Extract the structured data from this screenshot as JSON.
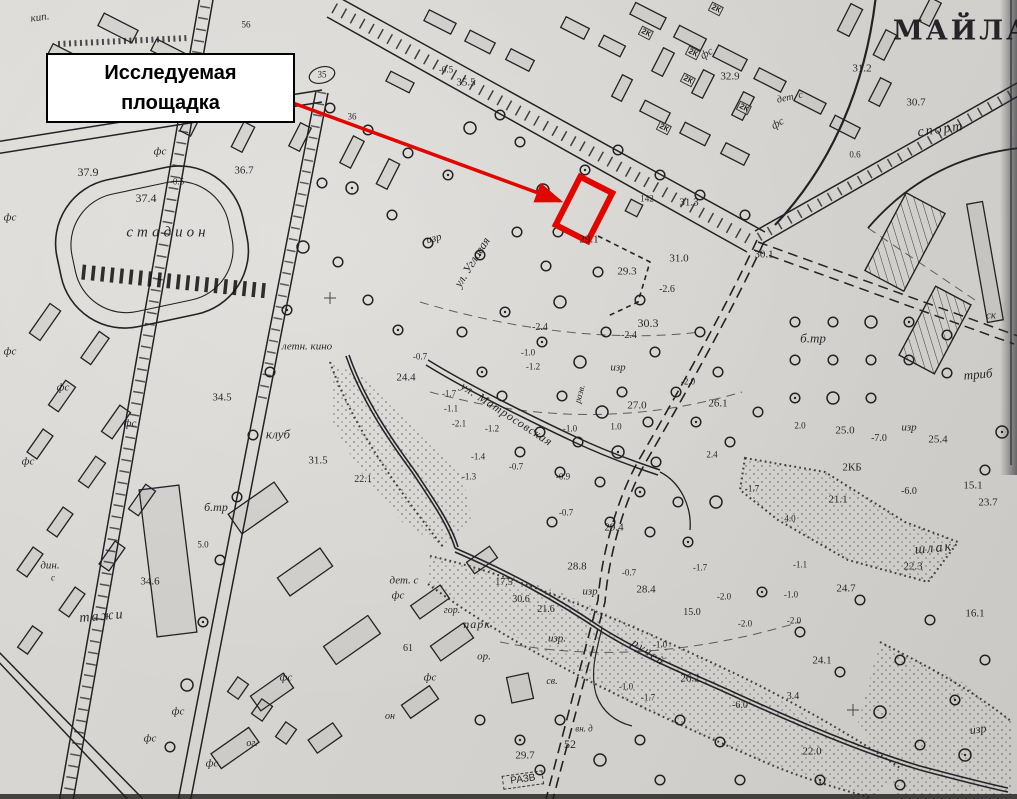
{
  "annotation": {
    "line1": "Исследуемая",
    "line2": "площадка"
  },
  "colors": {
    "paper": "#d6d4d0",
    "ink": "#222222",
    "highlight_red": "#e10600"
  },
  "map": {
    "title_street": "МАЙЛА",
    "street_names": [
      "ул. Угловая",
      "ул. Матросовская"
    ],
    "place_names": [
      "стадион",
      "спорт",
      "клуб",
      "летн. кино",
      "ручей",
      "шлак",
      "парк"
    ],
    "labels": [
      {
        "t": "МАЙЛА",
        "x": 962,
        "y": 31,
        "c": "b",
        "s": 27,
        "ls": 3
      },
      {
        "t": "стадион",
        "x": 168,
        "y": 233,
        "c": "p",
        "s": 15,
        "ls": 4
      },
      {
        "t": "спорт",
        "x": 941,
        "y": 130,
        "c": "p",
        "s": 14,
        "ls": 2,
        "r": -8
      },
      {
        "t": "ул. Угловая",
        "x": 472,
        "y": 262,
        "c": "p",
        "s": 12,
        "r": -58
      },
      {
        "t": "ул. Матросовская",
        "x": 507,
        "y": 414,
        "c": "p",
        "s": 12,
        "ls": 1,
        "r": 33
      },
      {
        "t": "клуб",
        "x": 278,
        "y": 434,
        "c": "p",
        "s": 13
      },
      {
        "t": "летн. кино",
        "x": 307,
        "y": 347,
        "c": "p",
        "s": 11
      },
      {
        "t": "ручей",
        "x": 649,
        "y": 652,
        "c": "p",
        "s": 12,
        "ls": 2,
        "r": 35
      },
      {
        "t": "шлак",
        "x": 934,
        "y": 549,
        "c": "p",
        "s": 14,
        "ls": 2,
        "r": -5
      },
      {
        "t": "б.тр",
        "x": 813,
        "y": 338,
        "c": "p",
        "s": 13
      },
      {
        "t": "б.тр",
        "x": 216,
        "y": 507,
        "c": "p",
        "s": 12
      },
      {
        "t": "изр",
        "x": 434,
        "y": 239,
        "c": "p",
        "s": 11,
        "r": -15
      },
      {
        "t": "изр",
        "x": 618,
        "y": 368,
        "c": "p",
        "s": 11
      },
      {
        "t": "изр",
        "x": 909,
        "y": 428,
        "c": "p",
        "s": 11
      },
      {
        "t": "изр",
        "x": 590,
        "y": 592,
        "c": "p",
        "s": 11
      },
      {
        "t": "изр.",
        "x": 557,
        "y": 639,
        "c": "p",
        "s": 11
      },
      {
        "t": "изр",
        "x": 978,
        "y": 729,
        "c": "p",
        "s": 12,
        "r": -8
      },
      {
        "t": "дет. с",
        "x": 790,
        "y": 98,
        "c": "p",
        "s": 10,
        "r": -12
      },
      {
        "t": "дет. с",
        "x": 404,
        "y": 581,
        "c": "p",
        "s": 11
      },
      {
        "t": "фс",
        "x": 398,
        "y": 596,
        "c": "p",
        "s": 11
      },
      {
        "t": "фс",
        "x": 707,
        "y": 54,
        "c": "p",
        "s": 11,
        "r": -30
      },
      {
        "t": "фс",
        "x": 778,
        "y": 124,
        "c": "p",
        "s": 11,
        "r": -30
      },
      {
        "t": "фс",
        "x": 160,
        "y": 152,
        "c": "p",
        "s": 11
      },
      {
        "t": "фс",
        "x": 10,
        "y": 218,
        "c": "p",
        "s": 11
      },
      {
        "t": "фс",
        "x": 10,
        "y": 352,
        "c": "p",
        "s": 11
      },
      {
        "t": "фс",
        "x": 63,
        "y": 388,
        "c": "p",
        "s": 11
      },
      {
        "t": "фс",
        "x": 130,
        "y": 424,
        "c": "p",
        "s": 11
      },
      {
        "t": "фс",
        "x": 28,
        "y": 462,
        "c": "p",
        "s": 11
      },
      {
        "t": "фс",
        "x": 286,
        "y": 678,
        "c": "p",
        "s": 11
      },
      {
        "t": "фс",
        "x": 430,
        "y": 678,
        "c": "p",
        "s": 11
      },
      {
        "t": "фс",
        "x": 178,
        "y": 712,
        "c": "p",
        "s": 11
      },
      {
        "t": "фс",
        "x": 150,
        "y": 739,
        "c": "p",
        "s": 11
      },
      {
        "t": "фс",
        "x": 212,
        "y": 764,
        "c": "p",
        "s": 11
      },
      {
        "t": "ог.",
        "x": 252,
        "y": 744,
        "c": "p",
        "s": 10
      },
      {
        "t": "он",
        "x": 390,
        "y": 717,
        "c": "p",
        "s": 10
      },
      {
        "t": "гор.",
        "x": 452,
        "y": 611,
        "c": "p",
        "s": 10
      },
      {
        "t": "парк",
        "x": 477,
        "y": 624,
        "c": "p",
        "s": 12,
        "ls": 1
      },
      {
        "t": "ор.",
        "x": 484,
        "y": 657,
        "c": "p",
        "s": 11
      },
      {
        "t": "св.",
        "x": 552,
        "y": 682,
        "c": "p",
        "s": 10
      },
      {
        "t": "вн. д",
        "x": 584,
        "y": 729,
        "c": "p",
        "s": 9
      },
      {
        "t": "дин.",
        "x": 50,
        "y": 566,
        "c": "p",
        "s": 11
      },
      {
        "t": "с",
        "x": 53,
        "y": 578,
        "c": "p",
        "s": 9
      },
      {
        "t": "тажи",
        "x": 102,
        "y": 617,
        "c": "p",
        "s": 14,
        "ls": 2,
        "r": -5
      },
      {
        "t": "триб",
        "x": 978,
        "y": 374,
        "c": "p",
        "s": 13,
        "r": -5
      },
      {
        "t": "ск",
        "x": 991,
        "y": 316,
        "c": "p",
        "s": 11
      },
      {
        "t": "кип.",
        "x": 40,
        "y": 18,
        "c": "p",
        "s": 11,
        "r": -8
      },
      {
        "t": "разв.",
        "x": 580,
        "y": 394,
        "c": "p",
        "s": 9,
        "r": -75
      },
      {
        "t": "РАЗВ",
        "x": 523,
        "y": 780,
        "c": "x",
        "s": 10,
        "r": -8
      },
      {
        "t": "37.9",
        "x": 88,
        "y": 172,
        "c": "n",
        "s": 12
      },
      {
        "t": "37.4",
        "x": 146,
        "y": 198,
        "c": "n",
        "s": 12
      },
      {
        "t": "36.7",
        "x": 244,
        "y": 171,
        "c": "n",
        "s": 11
      },
      {
        "t": "35.5",
        "x": 466,
        "y": 83,
        "c": "n",
        "s": 11
      },
      {
        "t": "35",
        "x": 322,
        "y": 75,
        "c": "n",
        "s": 9
      },
      {
        "t": "36",
        "x": 352,
        "y": 117,
        "c": "n",
        "s": 9
      },
      {
        "t": "56",
        "x": 246,
        "y": 25,
        "c": "n",
        "s": 9
      },
      {
        "t": "-0.5",
        "x": 177,
        "y": 182,
        "c": "n",
        "s": 9
      },
      {
        "t": "-0.5",
        "x": 446,
        "y": 70,
        "c": "n",
        "s": 9
      },
      {
        "t": "32.9",
        "x": 730,
        "y": 77,
        "c": "n",
        "s": 11
      },
      {
        "t": "31.2",
        "x": 862,
        "y": 69,
        "c": "n",
        "s": 11
      },
      {
        "t": "30.7",
        "x": 916,
        "y": 103,
        "c": "n",
        "s": 11
      },
      {
        "t": "0.6",
        "x": 855,
        "y": 155,
        "c": "n",
        "s": 9
      },
      {
        "t": "142",
        "x": 647,
        "y": 199,
        "c": "n",
        "s": 9
      },
      {
        "t": "31.3",
        "x": 689,
        "y": 203,
        "c": "n",
        "s": 11
      },
      {
        "t": "29.1",
        "x": 589,
        "y": 240,
        "c": "n",
        "s": 11
      },
      {
        "t": "31.0",
        "x": 679,
        "y": 259,
        "c": "n",
        "s": 11
      },
      {
        "t": "29.3",
        "x": 627,
        "y": 272,
        "c": "n",
        "s": 11
      },
      {
        "t": "-2.6",
        "x": 667,
        "y": 290,
        "c": "n",
        "s": 10
      },
      {
        "t": "30.1",
        "x": 764,
        "y": 255,
        "c": "n",
        "s": 11
      },
      {
        "t": "30.3",
        "x": 648,
        "y": 323,
        "c": "n",
        "s": 12
      },
      {
        "t": "-2.4",
        "x": 540,
        "y": 328,
        "c": "n",
        "s": 10
      },
      {
        "t": "-2.4",
        "x": 629,
        "y": 336,
        "c": "n",
        "s": 10
      },
      {
        "t": "-1.0",
        "x": 528,
        "y": 353,
        "c": "n",
        "s": 9
      },
      {
        "t": "-1.2",
        "x": 533,
        "y": 367,
        "c": "n",
        "s": 9
      },
      {
        "t": "-2.0",
        "x": 688,
        "y": 382,
        "c": "n",
        "s": 9
      },
      {
        "t": "26.1",
        "x": 718,
        "y": 404,
        "c": "n",
        "s": 11
      },
      {
        "t": "27.0",
        "x": 637,
        "y": 406,
        "c": "n",
        "s": 11
      },
      {
        "t": "-1.7",
        "x": 449,
        "y": 394,
        "c": "n",
        "s": 9
      },
      {
        "t": "-1.1",
        "x": 451,
        "y": 409,
        "c": "n",
        "s": 9
      },
      {
        "t": "-2.1",
        "x": 459,
        "y": 424,
        "c": "n",
        "s": 9
      },
      {
        "t": "-1.2",
        "x": 492,
        "y": 429,
        "c": "n",
        "s": 9
      },
      {
        "t": "-1.0",
        "x": 570,
        "y": 429,
        "c": "n",
        "s": 9
      },
      {
        "t": "1.0",
        "x": 616,
        "y": 427,
        "c": "n",
        "s": 9
      },
      {
        "t": "-1.4",
        "x": 478,
        "y": 457,
        "c": "n",
        "s": 9
      },
      {
        "t": "-1.3",
        "x": 469,
        "y": 477,
        "c": "n",
        "s": 9
      },
      {
        "t": "-0.7",
        "x": 516,
        "y": 467,
        "c": "n",
        "s": 9
      },
      {
        "t": "-0.9",
        "x": 563,
        "y": 477,
        "c": "n",
        "s": 9
      },
      {
        "t": "24.4",
        "x": 406,
        "y": 378,
        "c": "n",
        "s": 11
      },
      {
        "t": "-0.7",
        "x": 420,
        "y": 357,
        "c": "n",
        "s": 9
      },
      {
        "t": "34.5",
        "x": 222,
        "y": 398,
        "c": "n",
        "s": 11
      },
      {
        "t": "31.5",
        "x": 318,
        "y": 461,
        "c": "n",
        "s": 11
      },
      {
        "t": "22.1",
        "x": 363,
        "y": 480,
        "c": "n",
        "s": 10
      },
      {
        "t": "2.4",
        "x": 712,
        "y": 455,
        "c": "n",
        "s": 9
      },
      {
        "t": "-1.7",
        "x": 752,
        "y": 489,
        "c": "n",
        "s": 9
      },
      {
        "t": "2КБ",
        "x": 852,
        "y": 468,
        "c": "n",
        "s": 11
      },
      {
        "t": "-6.0",
        "x": 909,
        "y": 492,
        "c": "n",
        "s": 10
      },
      {
        "t": "21.1",
        "x": 838,
        "y": 500,
        "c": "n",
        "s": 11
      },
      {
        "t": "15.1",
        "x": 973,
        "y": 486,
        "c": "n",
        "s": 11
      },
      {
        "t": "23.7",
        "x": 988,
        "y": 503,
        "c": "n",
        "s": 11
      },
      {
        "t": "4.0",
        "x": 790,
        "y": 519,
        "c": "n",
        "s": 9
      },
      {
        "t": "-1.1",
        "x": 800,
        "y": 565,
        "c": "n",
        "s": 9
      },
      {
        "t": "22.3",
        "x": 913,
        "y": 567,
        "c": "n",
        "s": 11
      },
      {
        "t": "25.0",
        "x": 845,
        "y": 431,
        "c": "n",
        "s": 11
      },
      {
        "t": "2.0",
        "x": 800,
        "y": 426,
        "c": "n",
        "s": 9
      },
      {
        "t": "-7.0",
        "x": 879,
        "y": 439,
        "c": "n",
        "s": 10
      },
      {
        "t": "25.4",
        "x": 938,
        "y": 440,
        "c": "n",
        "s": 11
      },
      {
        "t": "29.4",
        "x": 614,
        "y": 528,
        "c": "n",
        "s": 11
      },
      {
        "t": "-0.7",
        "x": 566,
        "y": 513,
        "c": "n",
        "s": 9
      },
      {
        "t": "28.8",
        "x": 577,
        "y": 567,
        "c": "n",
        "s": 11
      },
      {
        "t": "-0.7",
        "x": 629,
        "y": 573,
        "c": "n",
        "s": 9
      },
      {
        "t": "28.4",
        "x": 646,
        "y": 590,
        "c": "n",
        "s": 11
      },
      {
        "t": "-1.7",
        "x": 700,
        "y": 568,
        "c": "n",
        "s": 9
      },
      {
        "t": "17.5",
        "x": 504,
        "y": 583,
        "c": "n",
        "s": 10
      },
      {
        "t": "30.6",
        "x": 521,
        "y": 600,
        "c": "n",
        "s": 10
      },
      {
        "t": "21.6",
        "x": 546,
        "y": 610,
        "c": "n",
        "s": 10
      },
      {
        "t": "61",
        "x": 408,
        "y": 649,
        "c": "n",
        "s": 10
      },
      {
        "t": "-2.0",
        "x": 724,
        "y": 597,
        "c": "n",
        "s": 9
      },
      {
        "t": "-1.0",
        "x": 791,
        "y": 595,
        "c": "n",
        "s": 9
      },
      {
        "t": "15.0",
        "x": 692,
        "y": 613,
        "c": "n",
        "s": 10
      },
      {
        "t": "-2.0",
        "x": 745,
        "y": 624,
        "c": "n",
        "s": 9
      },
      {
        "t": "-2.0",
        "x": 794,
        "y": 621,
        "c": "n",
        "s": 9
      },
      {
        "t": "-1.0",
        "x": 660,
        "y": 645,
        "c": "n",
        "s": 9
      },
      {
        "t": "26.2",
        "x": 690,
        "y": 679,
        "c": "n",
        "s": 11
      },
      {
        "t": "-1.0",
        "x": 626,
        "y": 687,
        "c": "n",
        "s": 9
      },
      {
        "t": "-1.7",
        "x": 648,
        "y": 698,
        "c": "n",
        "s": 9
      },
      {
        "t": "24.7",
        "x": 846,
        "y": 589,
        "c": "n",
        "s": 11
      },
      {
        "t": "24.1",
        "x": 822,
        "y": 661,
        "c": "n",
        "s": 11
      },
      {
        "t": "3.4",
        "x": 793,
        "y": 697,
        "c": "n",
        "s": 10
      },
      {
        "t": "-6.0",
        "x": 740,
        "y": 706,
        "c": "n",
        "s": 10
      },
      {
        "t": "16.1",
        "x": 975,
        "y": 614,
        "c": "n",
        "s": 11
      },
      {
        "t": "22.0",
        "x": 812,
        "y": 752,
        "c": "n",
        "s": 11
      },
      {
        "t": "29.7",
        "x": 525,
        "y": 756,
        "c": "n",
        "s": 11
      },
      {
        "t": "52",
        "x": 570,
        "y": 744,
        "c": "n",
        "s": 12
      },
      {
        "t": "34.6",
        "x": 150,
        "y": 582,
        "c": "n",
        "s": 11
      },
      {
        "t": "5.0",
        "x": 203,
        "y": 545,
        "c": "n",
        "s": 9
      },
      {
        "t": "2К",
        "x": 716,
        "y": 9,
        "c": "k",
        "s": 8,
        "r": 27
      },
      {
        "t": "2К",
        "x": 646,
        "y": 33,
        "c": "k",
        "s": 8,
        "r": 27
      },
      {
        "t": "2К",
        "x": 693,
        "y": 53,
        "c": "k",
        "s": 8,
        "r": 27
      },
      {
        "t": "2К",
        "x": 688,
        "y": 80,
        "c": "k",
        "s": 8,
        "r": 27
      },
      {
        "t": "2К",
        "x": 744,
        "y": 108,
        "c": "k",
        "s": 8,
        "r": 27
      },
      {
        "t": "2К",
        "x": 664,
        "y": 128,
        "c": "k",
        "s": 8,
        "r": 27
      }
    ]
  }
}
